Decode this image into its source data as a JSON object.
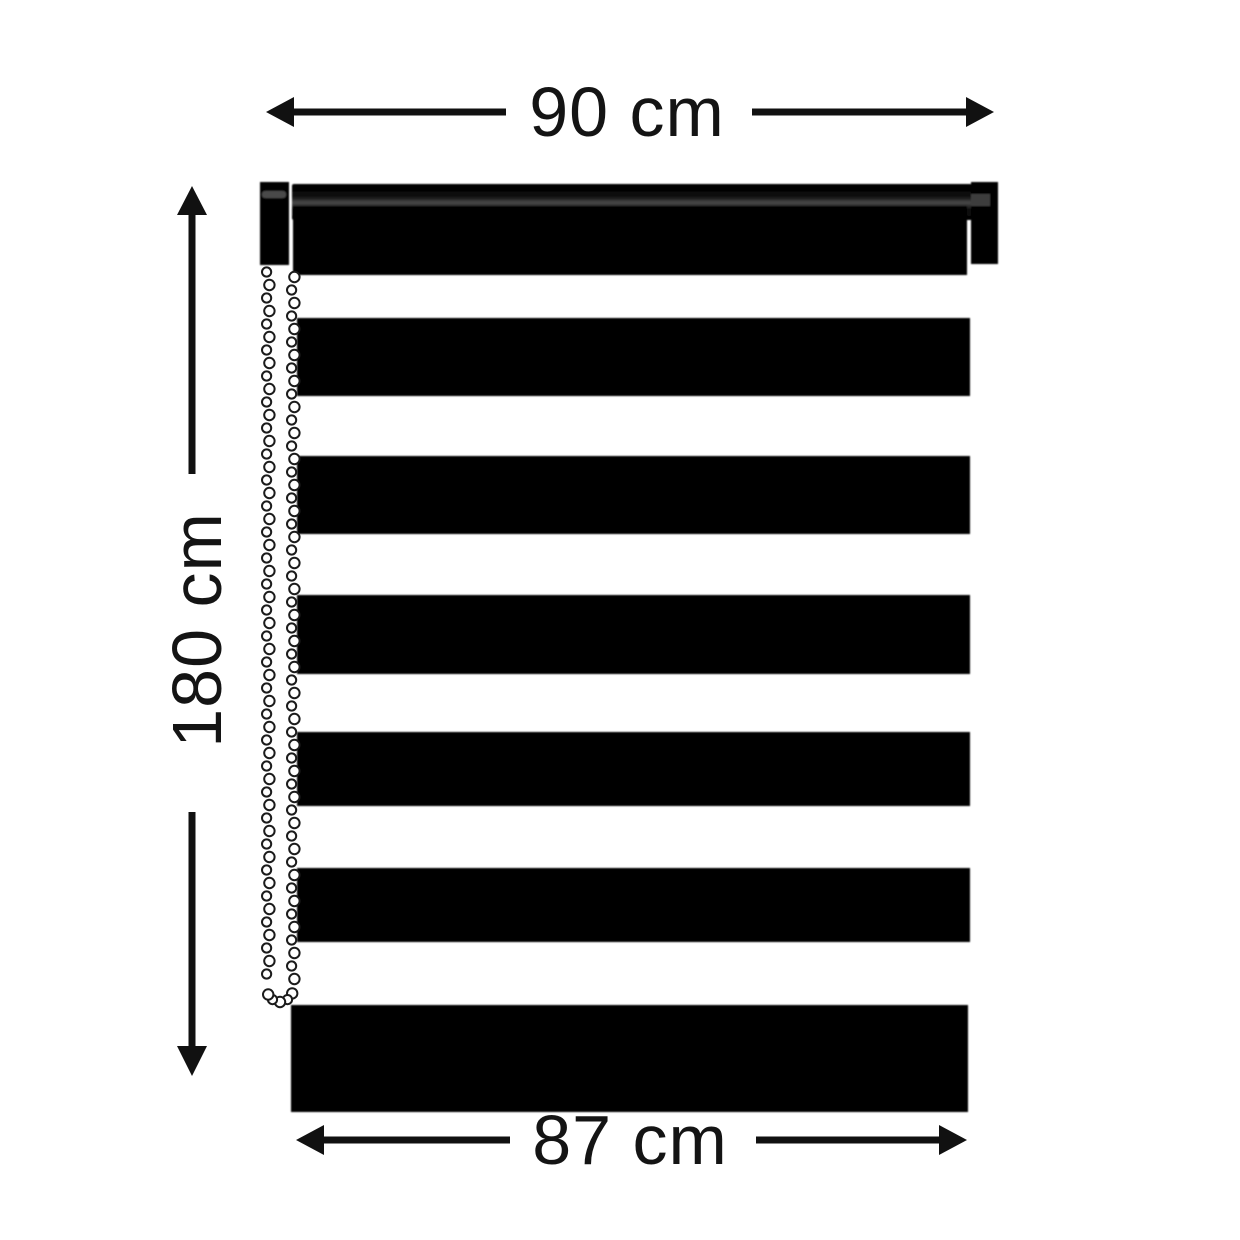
{
  "title": "Black zebra roller blind dimension diagram",
  "colors": {
    "background": "#ffffff",
    "ink": "#111111",
    "blind": "#000000",
    "tube_highlight": "#474747"
  },
  "dimensions": {
    "top_width": {
      "label": "90 cm"
    },
    "left_height": {
      "label": "180 cm"
    },
    "bottom_width": {
      "label": "87 cm"
    }
  },
  "blind": {
    "description": "black day-night (zebra) roller blind, headrail with end brackets, beaded pull chain loop hanging on the left",
    "stripes": [
      {
        "x": 297,
        "y": 318,
        "w": 673,
        "h": 78
      },
      {
        "x": 297,
        "y": 456,
        "w": 673,
        "h": 78
      },
      {
        "x": 297,
        "y": 595,
        "w": 673,
        "h": 79
      },
      {
        "x": 297,
        "y": 732,
        "w": 673,
        "h": 74
      },
      {
        "x": 297,
        "y": 868,
        "w": 673,
        "h": 74
      },
      {
        "x": 291,
        "y": 1005,
        "w": 677,
        "h": 107
      }
    ],
    "chain": {
      "left_x": 268,
      "right_x": 293,
      "top_y": 272,
      "bottom_y": 986,
      "loop_cx": 280,
      "loop_cy": 989,
      "loop_r": 13,
      "spacing": 13
    }
  }
}
